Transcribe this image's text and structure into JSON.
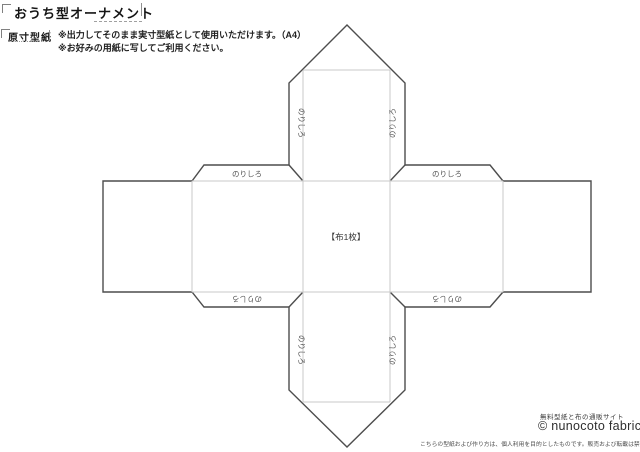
{
  "header": {
    "title": "おうち型オーナメント",
    "pattern_label": "原寸型紙",
    "note1": "※出力してそのまま実寸型紙として使用いただけます。（A4）",
    "note2": "※お好みの用紙に写してご利用ください。"
  },
  "pattern": {
    "glue_tab_label": "のりしろ",
    "center_label": "【布1枚】",
    "colors": {
      "cut_line": "#4d4d4d",
      "fold_line": "#c9c9c9",
      "label_text": "#555555",
      "center_text": "#333333"
    }
  },
  "footer": {
    "tagline": "無料型紙と布の通販サイト",
    "logo": "© nunocoto fabric",
    "disclaimer": "こちらの型紙および作り方は、個人利用を目的としたものです。販売および転載は禁止します。"
  }
}
